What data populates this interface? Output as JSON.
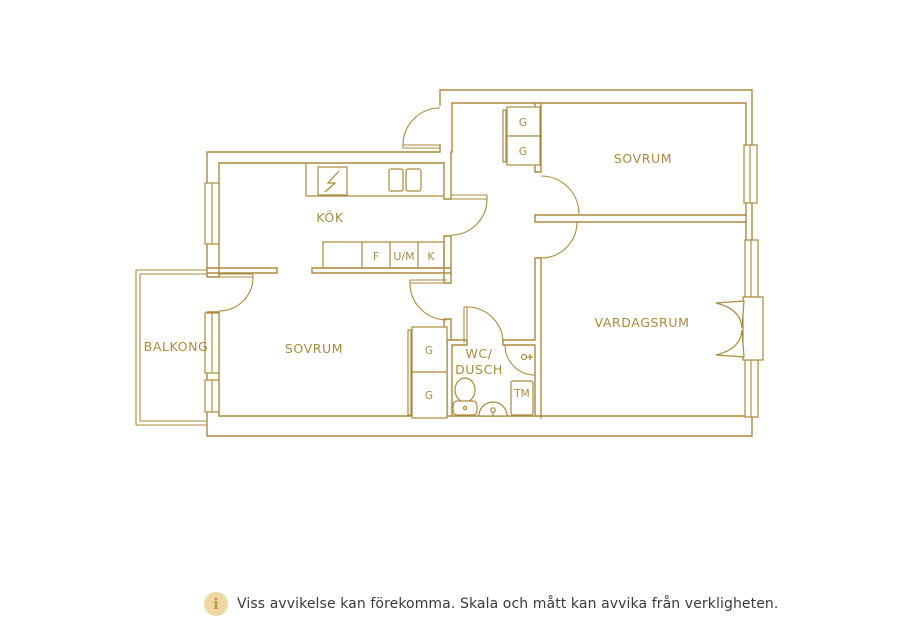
{
  "plan": {
    "rooms": {
      "kok": "KÖK",
      "sovrum_top": "SOVRUM",
      "sovrum_left": "SOVRUM",
      "vardagsrum": "VARDAGSRUM",
      "balkong": "BALKONG",
      "wc_line1": "WC/",
      "wc_line2": "DUSCH"
    },
    "fixtures": {
      "f": "F",
      "um": "U/M",
      "k": "K",
      "tm": "TM",
      "g1": "G",
      "g2": "G",
      "g3": "G",
      "g4": "G"
    },
    "colors": {
      "line": "#ab8a3d",
      "info_bg": "#eed9a5",
      "info_fg": "#c09b47"
    }
  },
  "footer": {
    "info_icon": "i",
    "disclaimer": "Viss avvikelse kan förekomma. Skala och mått kan avvika från verkligheten."
  }
}
